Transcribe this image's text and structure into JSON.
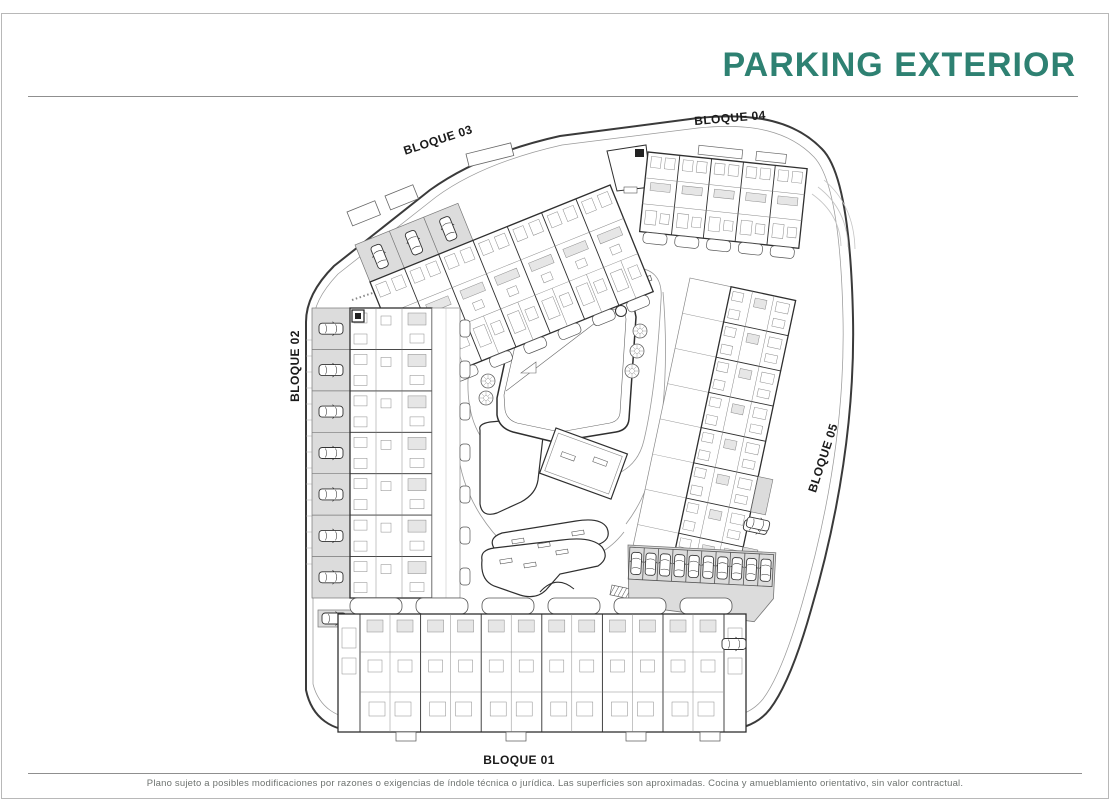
{
  "header": {
    "title": "PARKING EXTERIOR"
  },
  "plan": {
    "labels": [
      {
        "id": "bloque-01",
        "text": "BLOQUE 01"
      },
      {
        "id": "bloque-02",
        "text": "BLOQUE 02"
      },
      {
        "id": "bloque-03",
        "text": "BLOQUE 03"
      },
      {
        "id": "bloque-04",
        "text": "BLOQUE 04"
      },
      {
        "id": "bloque-05",
        "text": "BLOQUE 05"
      }
    ]
  },
  "footer": {
    "disclaimer": "Plano sujeto a posibles modificaciones por razones o exigencias de índole técnica o jurídica. Las superficies son aproximadas. Cocina y amueblamiento orientativo, sin valor contractual."
  },
  "colors": {
    "accent": "#2E8172",
    "plan_line": "#2f2f2f",
    "parking_fill": "#dcdcdc"
  }
}
